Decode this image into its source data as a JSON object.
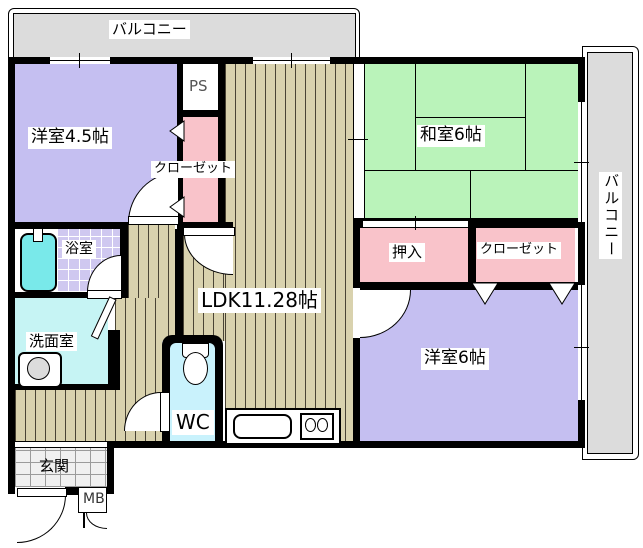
{
  "floorplan": {
    "balcony_top": {
      "label": "バルコニー"
    },
    "balcony_right": {
      "label": "バルコニー"
    },
    "rooms": {
      "western_room_45": {
        "label": "洋室4.5帖"
      },
      "pipe_space": {
        "label": "PS"
      },
      "closet_left": {
        "label": "クローゼット"
      },
      "japanese_room": {
        "label": "和室6帖"
      },
      "ldk": {
        "label": "LDK11.28帖"
      },
      "oshiire": {
        "label": "押入"
      },
      "closet_right": {
        "label": "クローゼット"
      },
      "western_room_6": {
        "label": "洋室6帖"
      },
      "bathroom": {
        "label": "浴室"
      },
      "washroom": {
        "label": "洗面室"
      },
      "toilet": {
        "label": "WC"
      },
      "entrance": {
        "label": "玄関"
      },
      "meter_box": {
        "label": "MB"
      }
    },
    "icons": [
      "bathtub-icon",
      "faucet-icon",
      "washing-machine-icon",
      "toilet-icon",
      "kitchen-sink-icon",
      "stove-burners-icon"
    ],
    "colors": {
      "wall": "#000000",
      "western_room": "#c5bff1",
      "japanese_room": "#baf3ba",
      "closet": "#f9c3ca",
      "wood_floor": "#d9d2ae",
      "balcony": "#dcdcdc",
      "washroom": "#c6f4f4",
      "wc": "#c9f2fc",
      "bathtub": "#79e9ea",
      "bath_tile": "#cfc8f0",
      "entrance_tile": "#f0f0f0",
      "white": "#ffffff"
    }
  }
}
